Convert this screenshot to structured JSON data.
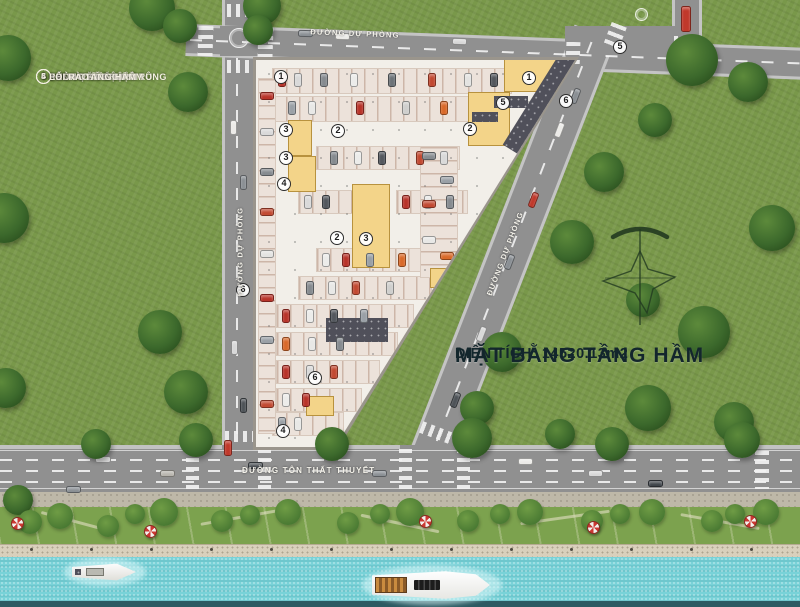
{
  "legend": {
    "items": [
      {
        "num": "1",
        "label": "- SẢNH CĂN HỘ"
      },
      {
        "num": "2",
        "label": "- KHU VỰC ĐỂ XE Ô TÔ"
      },
      {
        "num": "3",
        "label": "- PHÒNG KỸ THUẬT"
      },
      {
        "num": "4",
        "label": "- PHÒNG RÁC TẬP TRUNG"
      },
      {
        "num": "5",
        "label": "- LỐI VÀO TẦNG HẦM"
      },
      {
        "num": "6",
        "label": "- LỐI RA TẦNG HẦM"
      }
    ]
  },
  "title": {
    "line1": "MẶT BẰNG TẦNG HẦM",
    "line2": "DIỆN TÍCH: 14520.13m2"
  },
  "roads": {
    "top_name": "ĐƯỜNG DỰ PHÒNG",
    "left_name": "ĐƯỜNG DỰ PHÒNG",
    "diagonal_name": "ĐƯỜNG DỰ PHÒNG",
    "bottom_name": "ĐƯỜNG TÔN THẤT THUYẾT"
  },
  "colors": {
    "grass": "#79984a",
    "road": "#909090",
    "water": "#79d2d8",
    "plan": "#f2efe9",
    "room_yellow": "#f3d489",
    "ramp_dark": "#50505a",
    "title_text": "#13262c",
    "car_red": "#b8342a",
    "car_orange": "#d96a2a",
    "umbrella_red": "#cc3832"
  },
  "markers": [
    {
      "n": "1",
      "x": 281,
      "y": 77
    },
    {
      "n": "3",
      "x": 286,
      "y": 130
    },
    {
      "n": "2",
      "x": 338,
      "y": 131
    },
    {
      "n": "3",
      "x": 286,
      "y": 158
    },
    {
      "n": "4",
      "x": 284,
      "y": 184
    },
    {
      "n": "2",
      "x": 337,
      "y": 238
    },
    {
      "n": "3",
      "x": 366,
      "y": 239
    },
    {
      "n": "1",
      "x": 529,
      "y": 78
    },
    {
      "n": "5",
      "x": 503,
      "y": 103
    },
    {
      "n": "2",
      "x": 470,
      "y": 129
    },
    {
      "n": "6",
      "x": 566,
      "y": 101
    },
    {
      "n": "6",
      "x": 315,
      "y": 378
    },
    {
      "n": "4",
      "x": 283,
      "y": 431
    },
    {
      "n": "6",
      "x": 243,
      "y": 290
    },
    {
      "n": "5",
      "x": 620,
      "y": 47
    }
  ],
  "plan": {
    "bands": [
      [
        272,
        68,
        240,
        26,
        "x"
      ],
      [
        272,
        96,
        202,
        26,
        "x"
      ],
      [
        316,
        146,
        144,
        24,
        "x"
      ],
      [
        298,
        190,
        58,
        24,
        "x"
      ],
      [
        396,
        190,
        72,
        24,
        "x"
      ],
      [
        316,
        248,
        126,
        24,
        "x"
      ],
      [
        298,
        276,
        134,
        24,
        "x"
      ],
      [
        276,
        304,
        138,
        24,
        "x"
      ],
      [
        276,
        332,
        122,
        24,
        "x"
      ],
      [
        276,
        360,
        104,
        24,
        "x"
      ],
      [
        276,
        388,
        86,
        24,
        "x"
      ],
      [
        272,
        412,
        72,
        24,
        "x"
      ],
      [
        258,
        78,
        18,
        356,
        "y"
      ],
      [
        420,
        146,
        38,
        132,
        "y"
      ]
    ],
    "rooms": [
      [
        288,
        120,
        24,
        36
      ],
      [
        288,
        156,
        28,
        36
      ],
      [
        352,
        184,
        38,
        84
      ],
      [
        504,
        58,
        60,
        34
      ],
      [
        468,
        92,
        42,
        54
      ],
      [
        430,
        268,
        26,
        20
      ],
      [
        306,
        396,
        28,
        20
      ]
    ],
    "dark_blocks": [
      [
        326,
        318,
        62,
        24
      ],
      [
        472,
        112,
        26,
        10
      ],
      [
        494,
        96,
        34,
        12
      ]
    ],
    "ramp": [
      529,
      53,
      38,
      110
    ],
    "cars": [
      [
        278,
        73,
        8,
        14,
        "#b8342a"
      ],
      [
        294,
        73,
        8,
        14,
        "#d9d9d9"
      ],
      [
        320,
        73,
        8,
        14,
        "#868b90"
      ],
      [
        350,
        73,
        8,
        14,
        "#ececea"
      ],
      [
        388,
        73,
        8,
        14,
        "#6d7378"
      ],
      [
        428,
        73,
        8,
        14,
        "#c24a32"
      ],
      [
        464,
        73,
        8,
        14,
        "#e3e3e1"
      ],
      [
        490,
        73,
        8,
        14,
        "#54585e"
      ],
      [
        288,
        101,
        8,
        14,
        "#9aa0a6"
      ],
      [
        308,
        101,
        8,
        14,
        "#e8e8e6"
      ],
      [
        356,
        101,
        8,
        14,
        "#b8342a"
      ],
      [
        402,
        101,
        8,
        14,
        "#cfcfcd"
      ],
      [
        440,
        101,
        8,
        14,
        "#d96a2a"
      ],
      [
        330,
        151,
        8,
        14,
        "#868b90"
      ],
      [
        354,
        151,
        8,
        14,
        "#ececea"
      ],
      [
        378,
        151,
        8,
        14,
        "#54585e"
      ],
      [
        416,
        151,
        8,
        14,
        "#c24a32"
      ],
      [
        440,
        151,
        8,
        14,
        "#d9d9d9"
      ],
      [
        304,
        195,
        8,
        14,
        "#d9d9d9"
      ],
      [
        322,
        195,
        8,
        14,
        "#54585e"
      ],
      [
        402,
        195,
        8,
        14,
        "#b8342a"
      ],
      [
        424,
        195,
        8,
        14,
        "#e8e8e6"
      ],
      [
        446,
        195,
        8,
        14,
        "#868b90"
      ],
      [
        322,
        253,
        8,
        14,
        "#ececea"
      ],
      [
        342,
        253,
        8,
        14,
        "#b8342a"
      ],
      [
        366,
        253,
        8,
        14,
        "#9aa0a6"
      ],
      [
        398,
        253,
        8,
        14,
        "#d96a2a"
      ],
      [
        306,
        281,
        8,
        14,
        "#868b90"
      ],
      [
        328,
        281,
        8,
        14,
        "#e8e8e6"
      ],
      [
        352,
        281,
        8,
        14,
        "#c24a32"
      ],
      [
        386,
        281,
        8,
        14,
        "#cfcfcd"
      ],
      [
        282,
        309,
        8,
        14,
        "#b8342a"
      ],
      [
        306,
        309,
        8,
        14,
        "#ececea"
      ],
      [
        330,
        309,
        8,
        14,
        "#54585e"
      ],
      [
        360,
        309,
        8,
        14,
        "#9aa0a6"
      ],
      [
        282,
        337,
        8,
        14,
        "#d96a2a"
      ],
      [
        308,
        337,
        8,
        14,
        "#e8e8e6"
      ],
      [
        336,
        337,
        8,
        14,
        "#868b90"
      ],
      [
        282,
        365,
        8,
        14,
        "#b8342a"
      ],
      [
        306,
        365,
        8,
        14,
        "#d9d9d9"
      ],
      [
        330,
        365,
        8,
        14,
        "#c24a32"
      ],
      [
        282,
        393,
        8,
        14,
        "#ececea"
      ],
      [
        302,
        393,
        8,
        14,
        "#b8342a"
      ],
      [
        278,
        417,
        8,
        14,
        "#9aa0a6"
      ],
      [
        294,
        417,
        8,
        14,
        "#e8e8e6"
      ],
      [
        260,
        92,
        14,
        8,
        "#b8342a"
      ],
      [
        260,
        128,
        14,
        8,
        "#d9d9d9"
      ],
      [
        260,
        168,
        14,
        8,
        "#868b90"
      ],
      [
        260,
        208,
        14,
        8,
        "#c24a32"
      ],
      [
        260,
        250,
        14,
        8,
        "#e3e3e1"
      ],
      [
        260,
        294,
        14,
        8,
        "#b8342a"
      ],
      [
        260,
        336,
        14,
        8,
        "#9aa0a6"
      ],
      [
        260,
        400,
        14,
        8,
        "#c24a32"
      ],
      [
        422,
        152,
        14,
        8,
        "#868b90"
      ],
      [
        422,
        200,
        14,
        8,
        "#c24a32"
      ],
      [
        422,
        236,
        14,
        8,
        "#e8e8e6"
      ],
      [
        440,
        176,
        14,
        8,
        "#9aa0a6"
      ],
      [
        440,
        252,
        14,
        8,
        "#d96a2a"
      ]
    ]
  },
  "scene": {
    "trees": [
      [
        152,
        8,
        46
      ],
      [
        180,
        26,
        34
      ],
      [
        262,
        6,
        38
      ],
      [
        258,
        30,
        30
      ],
      [
        692,
        60,
        52
      ],
      [
        748,
        82,
        40
      ],
      [
        655,
        120,
        34
      ],
      [
        772,
        228,
        46
      ],
      [
        704,
        332,
        52
      ],
      [
        643,
        300,
        34
      ],
      [
        648,
        408,
        46
      ],
      [
        734,
        422,
        40
      ],
      [
        604,
        172,
        40
      ],
      [
        572,
        242,
        44
      ],
      [
        502,
        352,
        40
      ],
      [
        477,
        408,
        34
      ],
      [
        8,
        58,
        46
      ],
      [
        188,
        92,
        40
      ],
      [
        4,
        218,
        50
      ],
      [
        160,
        332,
        44
      ],
      [
        6,
        388,
        40
      ],
      [
        186,
        392,
        44
      ],
      [
        196,
        440,
        34
      ],
      [
        332,
        444,
        34
      ],
      [
        472,
        438,
        40
      ],
      [
        612,
        444,
        34
      ],
      [
        742,
        440,
        36
      ],
      [
        96,
        444,
        30
      ],
      [
        560,
        434,
        30
      ],
      [
        18,
        500,
        30
      ]
    ],
    "bushes": [
      [
        60,
        516,
        26
      ],
      [
        108,
        526,
        22
      ],
      [
        164,
        512,
        28
      ],
      [
        222,
        521,
        22
      ],
      [
        288,
        512,
        26
      ],
      [
        348,
        523,
        22
      ],
      [
        410,
        512,
        28
      ],
      [
        468,
        521,
        22
      ],
      [
        530,
        512,
        26
      ],
      [
        592,
        521,
        22
      ],
      [
        652,
        512,
        26
      ],
      [
        712,
        521,
        22
      ],
      [
        766,
        512,
        26
      ],
      [
        30,
        522,
        24
      ],
      [
        135,
        514,
        20
      ],
      [
        250,
        515,
        20
      ],
      [
        380,
        514,
        20
      ],
      [
        500,
        514,
        20
      ],
      [
        620,
        514,
        20
      ],
      [
        735,
        514,
        20
      ]
    ],
    "umbrellas": [
      [
        17,
        523
      ],
      [
        150,
        531
      ],
      [
        425,
        521
      ],
      [
        593,
        527
      ],
      [
        750,
        521
      ]
    ],
    "park_paths": [
      [
        40,
        520,
        70,
        15
      ],
      [
        200,
        515,
        90,
        -10
      ],
      [
        360,
        522,
        80,
        12
      ],
      [
        520,
        516,
        90,
        -8
      ],
      [
        680,
        520,
        80,
        10
      ]
    ],
    "bollards": [
      30,
      90,
      150,
      210,
      270,
      330,
      390,
      450,
      510,
      570,
      630,
      690,
      750
    ],
    "road_cars": [
      [
        95,
        456,
        16,
        7,
        "#d8d8d8",
        0
      ],
      [
        248,
        462,
        15,
        7,
        "#4e5358",
        0
      ],
      [
        372,
        470,
        15,
        7,
        "#8a8f94",
        0
      ],
      [
        518,
        458,
        15,
        7,
        "#ecebe8",
        0
      ],
      [
        648,
        480,
        15,
        7,
        "#3f444a",
        0
      ],
      [
        66,
        486,
        15,
        7,
        "#8a8f94",
        0
      ],
      [
        588,
        470,
        15,
        7,
        "#d8d8d8",
        0
      ],
      [
        160,
        470,
        15,
        7,
        "#b8b5ae",
        0
      ],
      [
        224,
        440,
        8,
        16,
        "#c0392b",
        0
      ],
      [
        230,
        120,
        7,
        15,
        "#ecebe8",
        0
      ],
      [
        240,
        175,
        7,
        15,
        "#8a8f94",
        0
      ],
      [
        231,
        340,
        7,
        15,
        "#d8d8d8",
        0
      ],
      [
        240,
        398,
        7,
        15,
        "#4e5358",
        0
      ],
      [
        298,
        30,
        15,
        7,
        "#8a8f94",
        2
      ],
      [
        452,
        38,
        15,
        7,
        "#d8d8d8",
        2
      ],
      [
        335,
        33,
        15,
        7,
        "#ecebe8",
        2
      ],
      [
        681,
        6,
        10,
        26,
        "#c0392b",
        0
      ],
      [
        556,
        122,
        7,
        16,
        "#ecebe8",
        21
      ],
      [
        530,
        192,
        7,
        16,
        "#c0392b",
        21
      ],
      [
        506,
        254,
        7,
        16,
        "#8a8f94",
        21
      ],
      [
        478,
        326,
        7,
        16,
        "#d8d8d8",
        21
      ],
      [
        452,
        392,
        7,
        16,
        "#4e5358",
        21
      ],
      [
        572,
        88,
        7,
        16,
        "#8a8f94",
        21
      ]
    ],
    "crosswalks": [
      [
        198,
        26,
        15,
        30,
        "y",
        2
      ],
      [
        258,
        27,
        15,
        30,
        "y",
        2
      ],
      [
        227,
        4,
        26,
        13,
        "x",
        0
      ],
      [
        227,
        60,
        26,
        13,
        "x",
        0
      ],
      [
        566,
        42,
        14,
        26,
        "y",
        2
      ],
      [
        607,
        24,
        16,
        24,
        "y",
        21
      ],
      [
        674,
        36,
        26,
        12,
        "x",
        0
      ],
      [
        186,
        449,
        13,
        40,
        "y",
        0
      ],
      [
        258,
        449,
        13,
        40,
        "y",
        0
      ],
      [
        399,
        449,
        13,
        40,
        "y",
        0
      ],
      [
        457,
        449,
        13,
        40,
        "y",
        0
      ],
      [
        755,
        451,
        14,
        38,
        "y",
        0
      ],
      [
        225,
        431,
        28,
        11,
        "x",
        0
      ],
      [
        420,
        427,
        34,
        12,
        "x",
        21
      ]
    ],
    "lane_dashes": [
      [
        0,
        459,
        800,
        "x",
        0,
        "center"
      ],
      [
        0,
        470,
        800,
        "x",
        0,
        "center"
      ],
      [
        0,
        481,
        800,
        "x",
        0,
        "center"
      ],
      [
        236,
        58,
        386,
        "y",
        0,
        "center"
      ],
      [
        190,
        39,
        610,
        "x",
        2.2,
        "left"
      ],
      [
        511,
        27,
        440,
        "y",
        21.2,
        "center"
      ]
    ],
    "edge_lines": [
      [
        0,
        450,
        800
      ],
      [
        0,
        488,
        800
      ]
    ],
    "road_circles": [
      [
        239,
        38,
        20
      ],
      [
        641,
        14,
        13
      ]
    ],
    "patches": [
      [
        220,
        26,
        38,
        30
      ],
      [
        565,
        26,
        115,
        30
      ],
      [
        400,
        445,
        60,
        12
      ],
      [
        222,
        445,
        34,
        10
      ]
    ],
    "boats": {
      "small": {
        "x": 72,
        "y": 562
      },
      "yacht": {
        "x": 372,
        "y": 570
      }
    }
  }
}
